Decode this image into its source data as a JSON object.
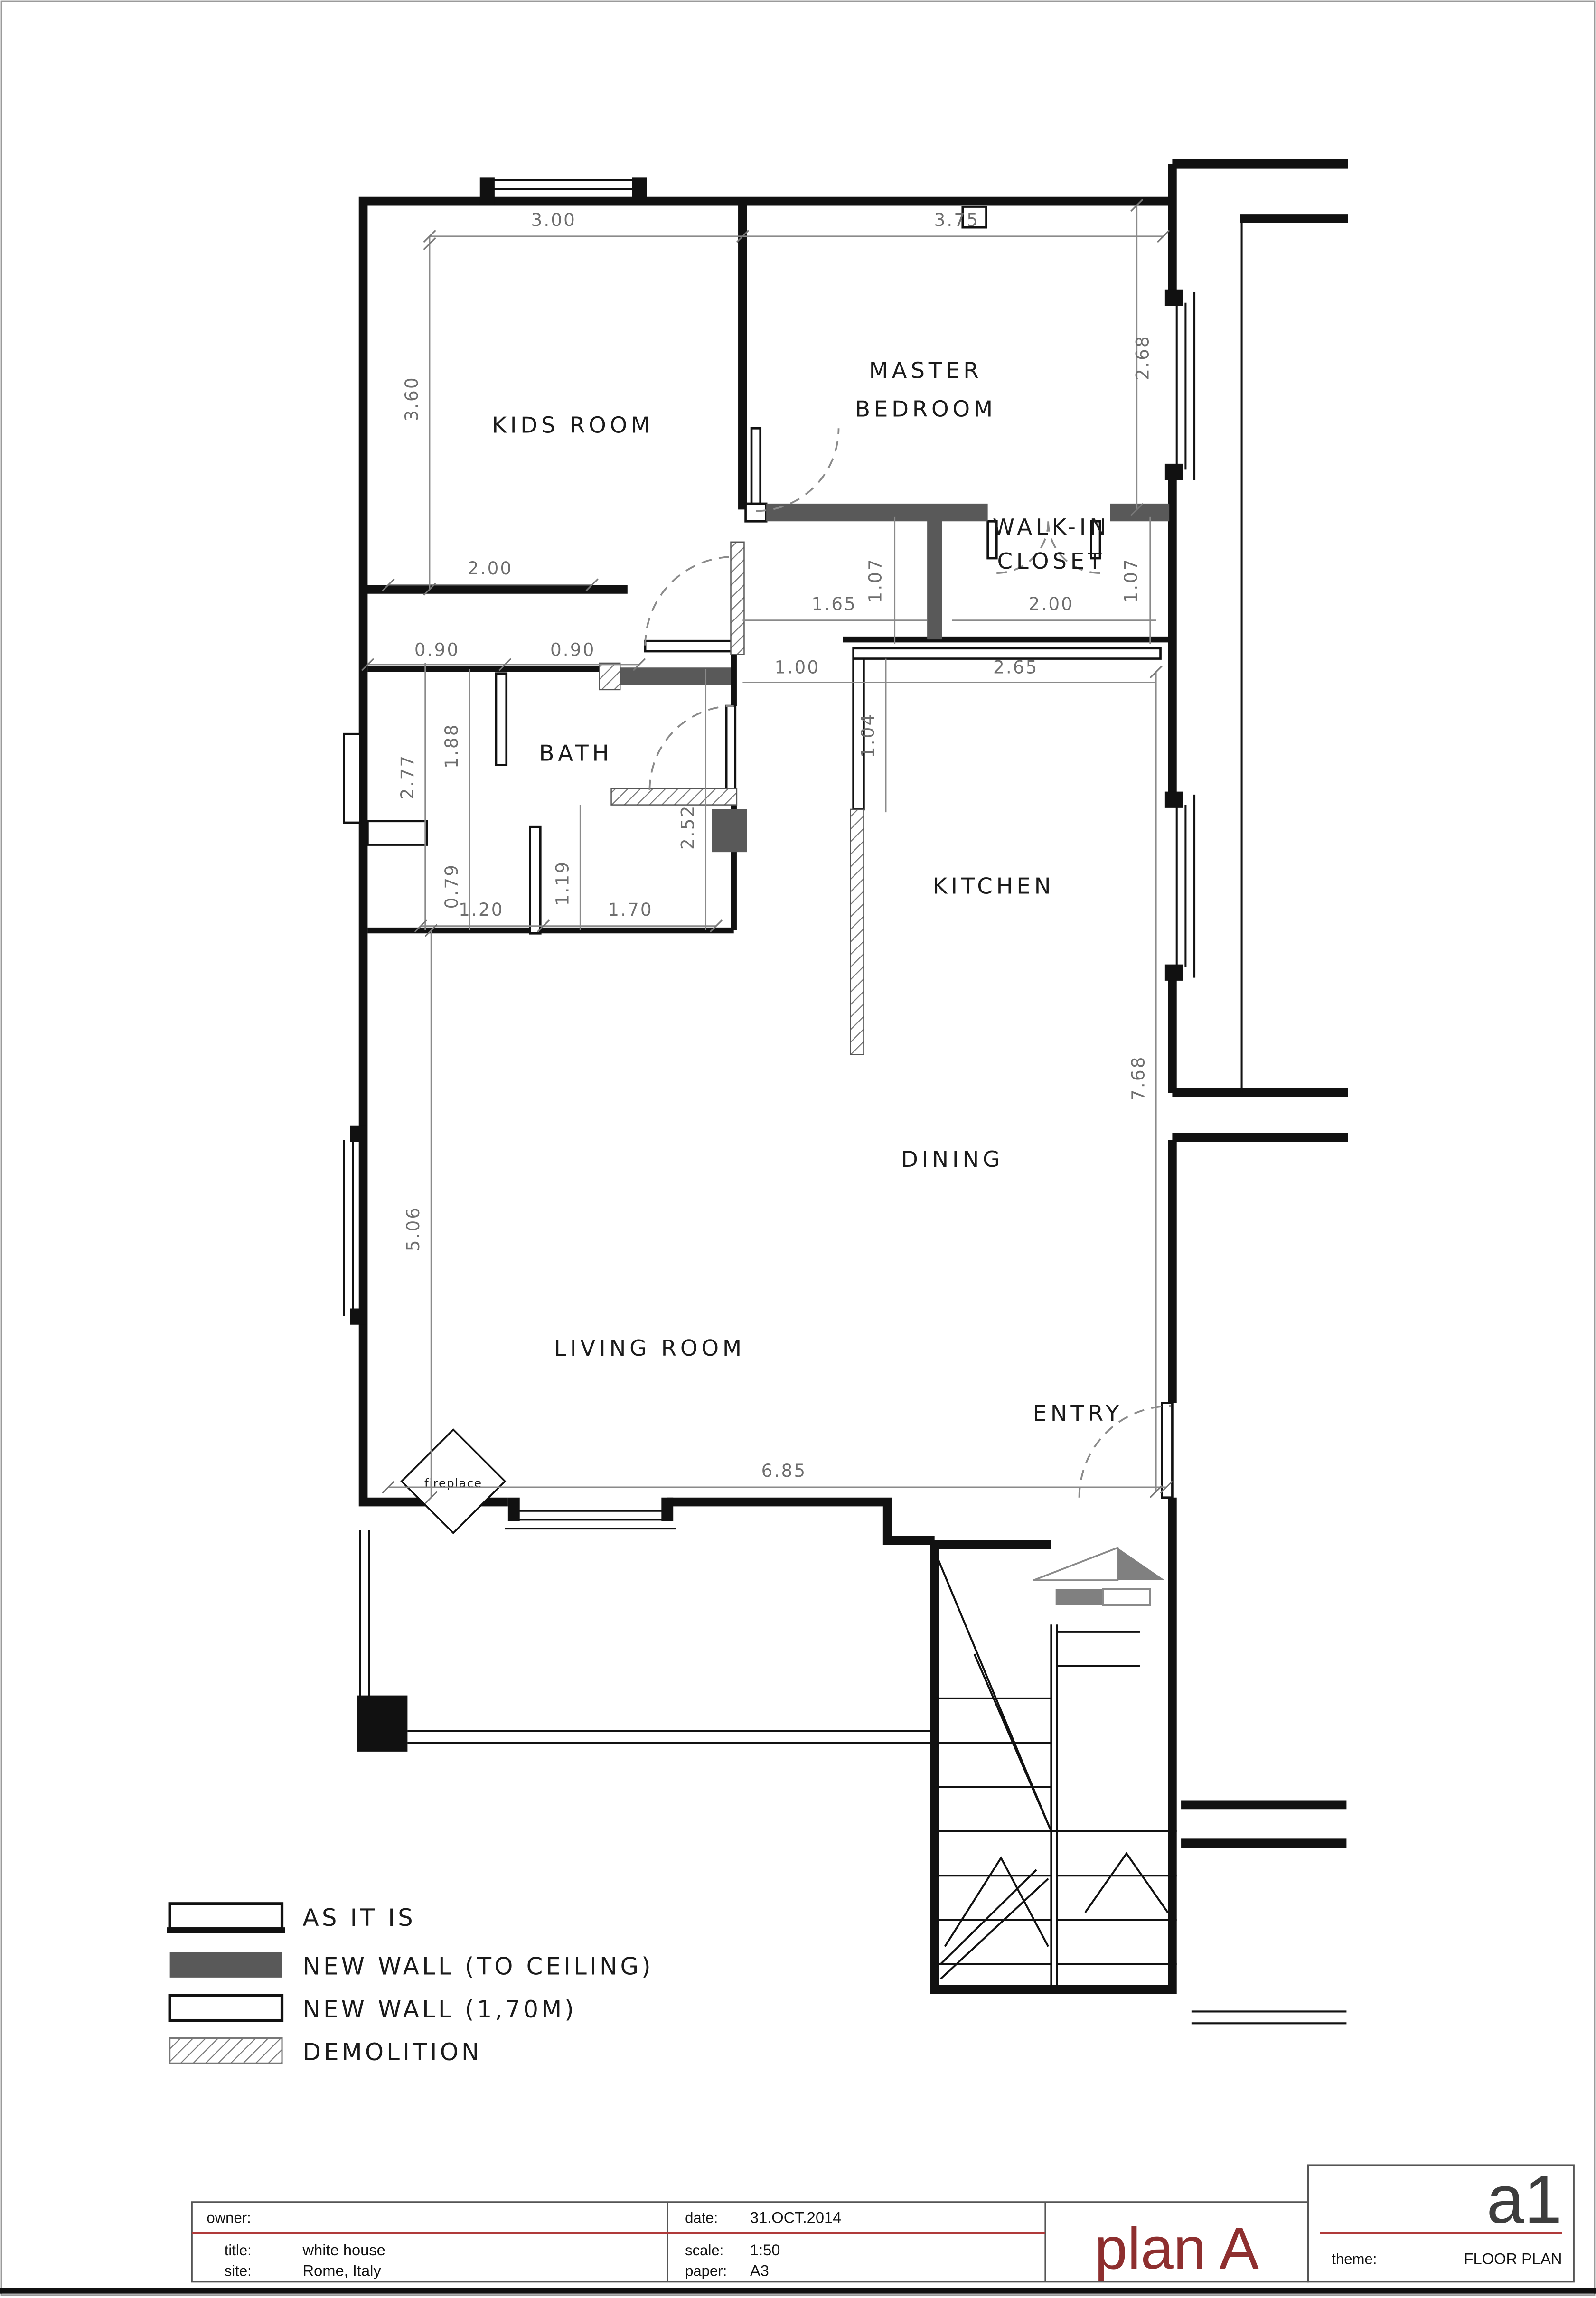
{
  "plan": {
    "rooms": {
      "kids": "KIDS ROOM",
      "master_line1": "MASTER",
      "master_line2": "BEDROOM",
      "closet_line1": "WALK-IN",
      "closet_line2": "CLOSET",
      "bath": "BATH",
      "kitchen": "KITCHEN",
      "dining": "DINING",
      "living": "LIVING ROOM",
      "entry": "ENTRY",
      "fireplace": "fireplace"
    },
    "dims": {
      "kids_top": "3.00",
      "master_top": "3.75",
      "kids_left": "3.60",
      "master_right": "2.68",
      "kids_bottom": "2.00",
      "hall_width": "1.65",
      "hall_height_left": "1.07",
      "closet_width": "2.00",
      "closet_height_right": "1.07",
      "bath_top_left": "0.90",
      "bath_top_right": "0.90",
      "corridor_width": "1.00",
      "kitchen_top": "2.65",
      "kitchen_wall": "1.04",
      "bath_left_outer": "2.77",
      "bath_left_upper": "1.88",
      "bath_left_lower": "0.79",
      "bath_bottom_left": "1.20",
      "bath_bottom_right": "1.70",
      "bath_inner": "1.19",
      "bath_right": "2.52",
      "kitchen_dining_right": "7.68",
      "living_left": "5.06",
      "living_bottom": "6.85"
    }
  },
  "legend": {
    "items": [
      {
        "label": "AS IT IS",
        "swatch": "as-it-is"
      },
      {
        "label": "NEW WALL (TO CEILING)",
        "swatch": "new-wall-to-ceiling"
      },
      {
        "label": "NEW WALL (1,70M)",
        "swatch": "new-wall-170"
      },
      {
        "label": "DEMOLITION",
        "swatch": "demolition"
      }
    ]
  },
  "titleblock": {
    "owner_label": "owner:",
    "title_label": "title:",
    "title_value": "white house",
    "site_label": "site:",
    "site_value": "Rome, Italy",
    "date_label": "date:",
    "date_value": "31.OCT.2014",
    "scale_label": "scale:",
    "scale_value": "1:50",
    "paper_label": "paper:",
    "paper_value": "A3",
    "plan_name": "plan A",
    "sheet_code": "a1",
    "theme_label": "theme:",
    "theme_value": "FLOOR PLAN"
  },
  "colors": {
    "new_wall_fill": "#595959",
    "wall_black": "#111111",
    "dim_gray": "#6e6e6e",
    "accent_red_line": "#b03a3a",
    "plan_title_red": "#8e2f2f",
    "sheet_code_gray": "#3d3d3d"
  }
}
